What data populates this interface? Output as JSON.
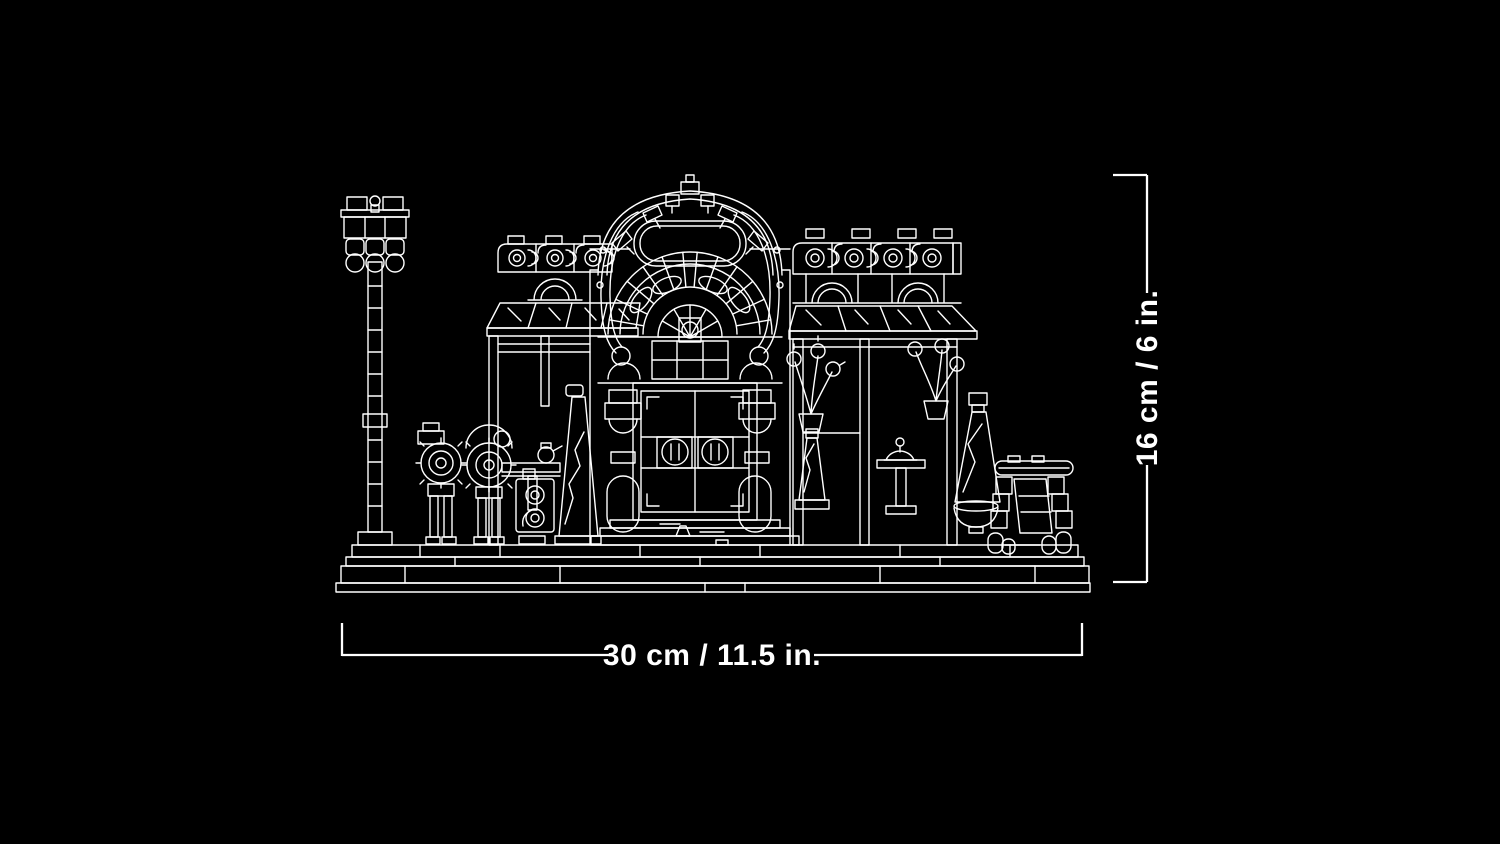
{
  "image": {
    "background_color": "#000000",
    "line_color": "#ffffff"
  },
  "illustration": {
    "icon": "lego-building-line-art",
    "parts": [
      "street-lamp",
      "left-wing",
      "entrance-pavilion",
      "right-wing",
      "outdoor-furniture",
      "base-platform"
    ]
  },
  "dimensions": {
    "height_label": "16 cm / 6 in.",
    "width_label": "30 cm / 11.5 in."
  }
}
